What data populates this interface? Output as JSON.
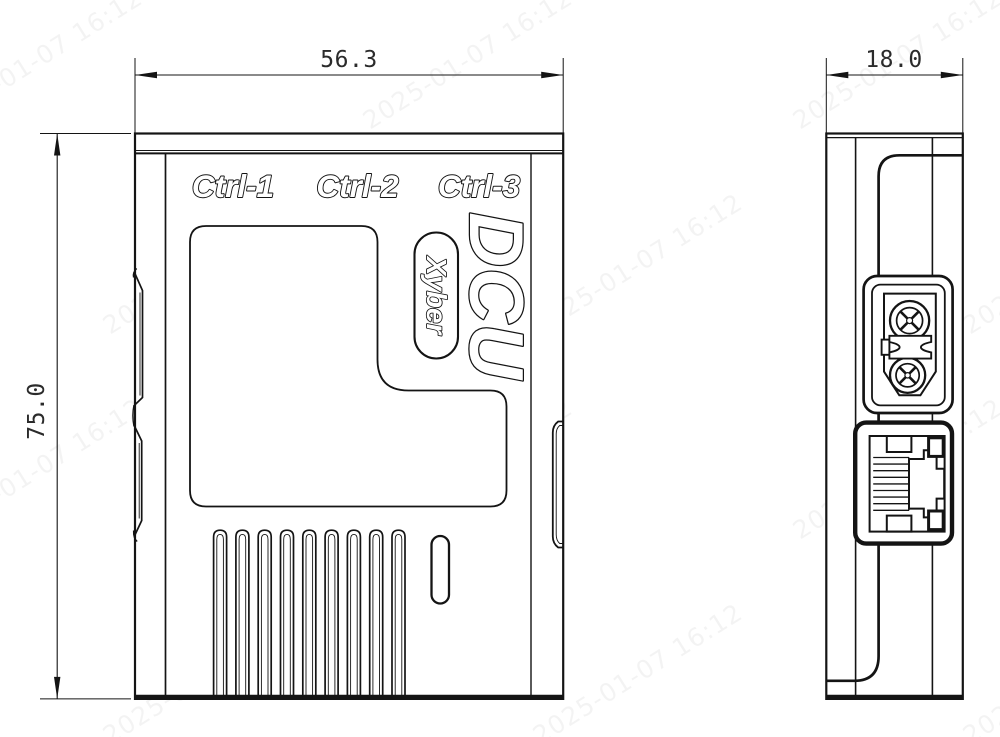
{
  "front_view": {
    "labels": [
      "Ctrl-1",
      "Ctrl-2",
      "Ctrl-3"
    ],
    "logo": {
      "product": "DCU",
      "brand": "Xyber"
    },
    "vent_slot_count": 9
  },
  "side_view": {
    "ports": [
      "power-connector",
      "ethernet-port"
    ]
  },
  "dimensions": {
    "width": "56.3",
    "depth": "18.0",
    "height": "75.0"
  },
  "watermark": "2025-01-07 16:12",
  "colors": {
    "line": "#141414",
    "background": "#ffffff",
    "dim_text": "#2b2b2b"
  }
}
